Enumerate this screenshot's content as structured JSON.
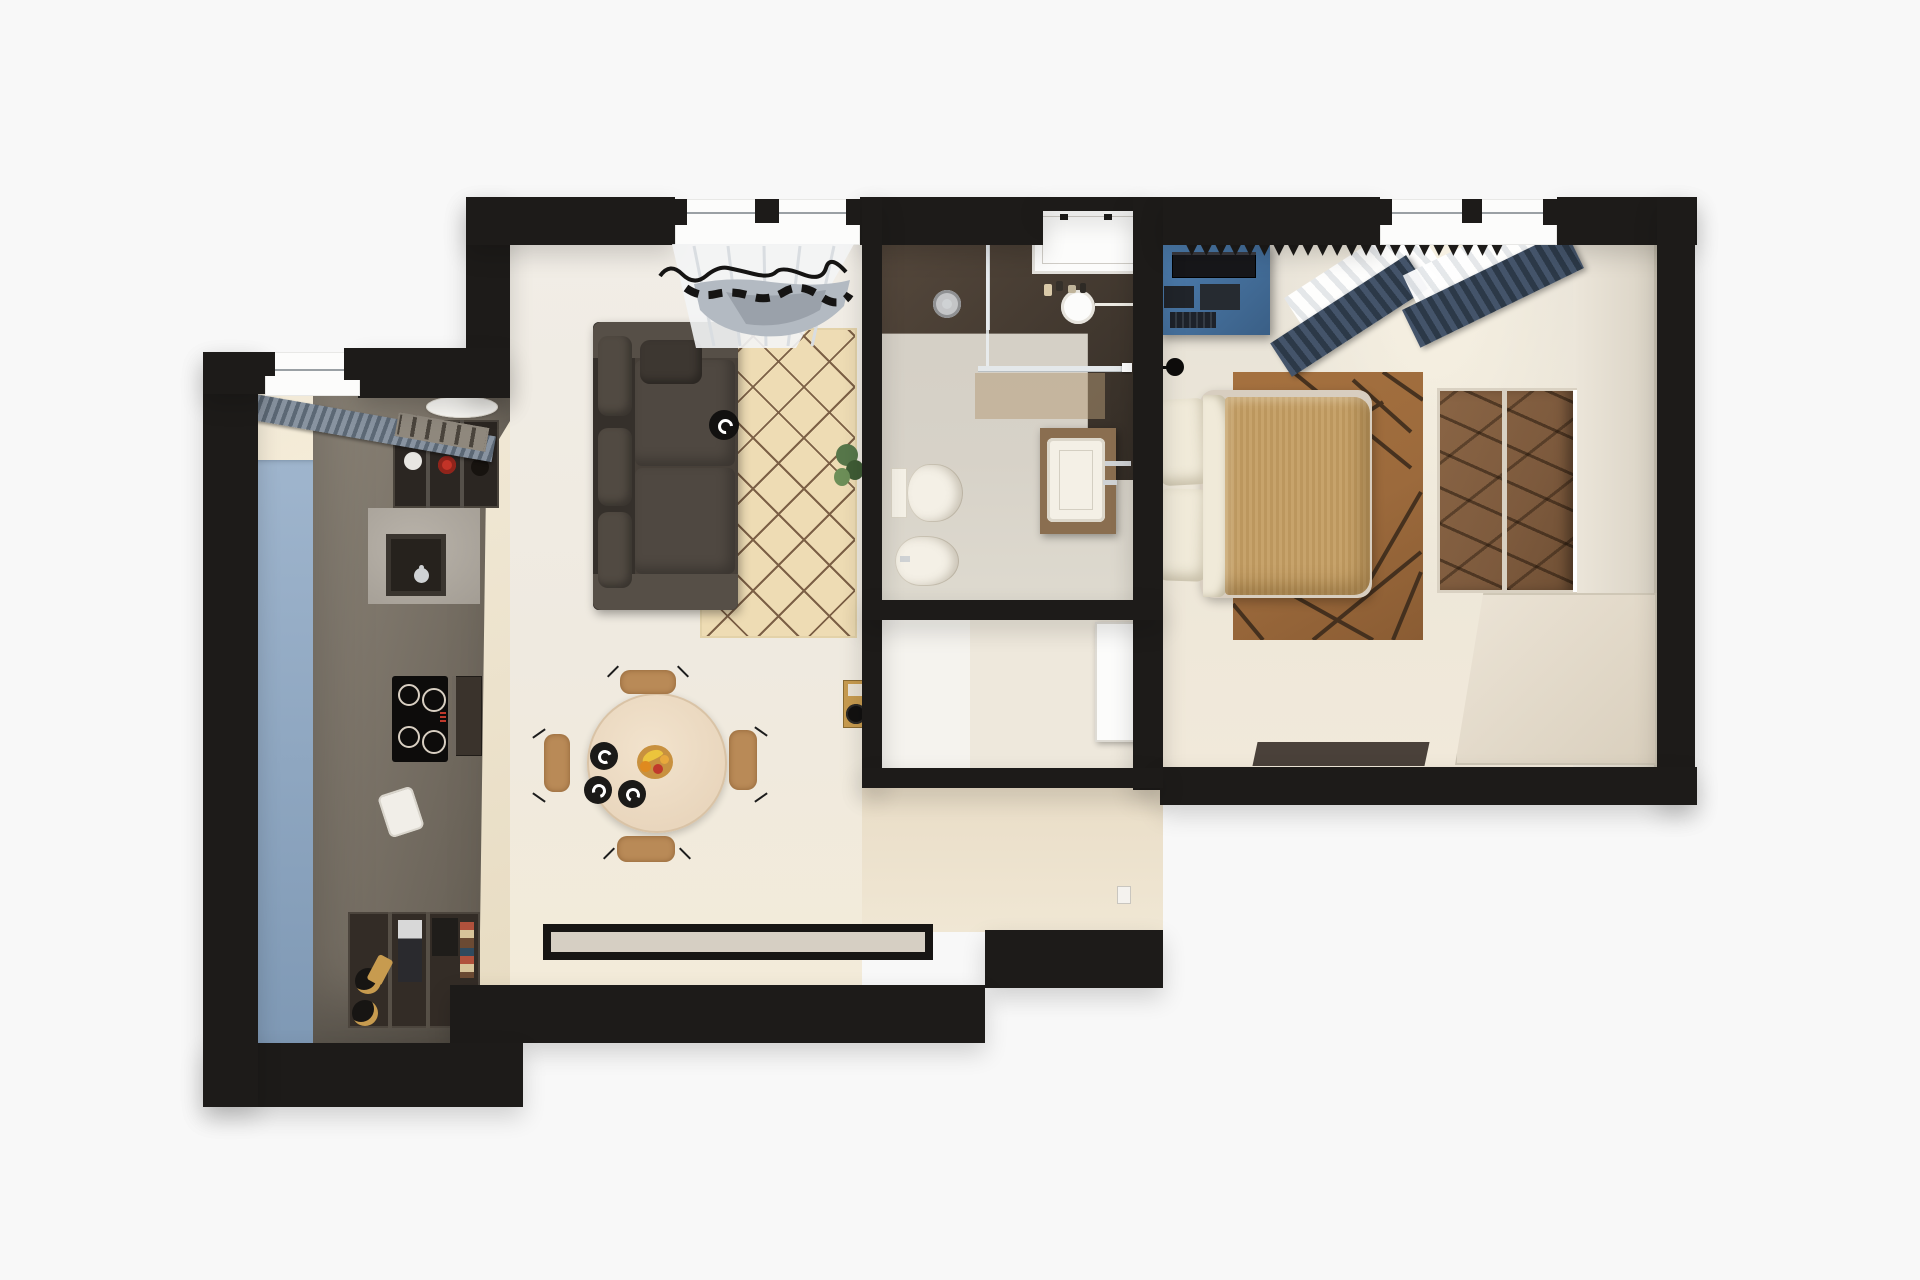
{
  "scene": {
    "type": "floor-plan-3d-top-view",
    "description": "Photorealistic top-down 3D render of a one-bedroom apartment floor plan on a white background, walls shown as black cut sections",
    "rooms": [
      {
        "id": "kitchen",
        "furniture": [
          "window-with-venetian-blind",
          "radiator-grille",
          "round-ceiling-plate",
          "tall-blue-cabinet-panel",
          "grey-cabinet-run",
          "bottle-cubby-shelf",
          "undermount-sink-with-faucet",
          "induction-cooktop",
          "built-in-oven",
          "toaster",
          "open-shelves-with-books",
          "coffee-machine",
          "wine-bottles"
        ],
        "cooktop_burners": 4
      },
      {
        "id": "living-dining-room",
        "furniture": [
          "window-with-sheer-and-grey-curtain",
          "dark-brown-sofa",
          "seat-cushions",
          "black-decor-plate",
          "diamond-pattern-tan-rug",
          "potted-plant",
          "wall-mounted-record-player",
          "round-wooden-dining-table",
          "black-plates",
          "fruit-bowl",
          "wooden-chairs",
          "black-bordered-runner-rug"
        ],
        "chairs": 4,
        "plates": 3,
        "fruit": [
          "bananas",
          "oranges",
          "red-apple"
        ]
      },
      {
        "id": "bathroom",
        "furniture": [
          "white-framed-window",
          "walk-in-shower",
          "shower-head",
          "glass-partition",
          "round-mirror",
          "cosmetic-bottles",
          "wood-vanity",
          "white-basin",
          "faucet",
          "wall-hung-toilet",
          "bidet"
        ]
      },
      {
        "id": "storage-nook",
        "furniture": [
          "white-door-ajar"
        ]
      },
      {
        "id": "hallway",
        "furniture": [
          "light-switch"
        ]
      },
      {
        "id": "bedroom",
        "furniture": [
          "window-with-sheer-curtain",
          "navy-pleated-curtains",
          "blue-desk",
          "tv-monitor",
          "black-wall-lamps",
          "double-bed",
          "white-pillows",
          "tan-duvet",
          "geometric-brown-rug",
          "mirrored-wardrobe",
          "dark-floor-mat"
        ],
        "wall_lamps": 2,
        "pillows": 2
      }
    ]
  },
  "glyphs": {
    "sawtooth_row_long": "▼▼▼▼▼▼▼▼▼▼▼▼▼▼▼▼▼▼▼▼▼▼",
    "sawtooth_row_small": "▼▼▼▼"
  },
  "colors": {
    "bg": "#f8f8f8",
    "wall": "#1d1b19",
    "window_white": "#fcfcfb",
    "glass": "#9aa0a4",
    "kitchen_floor_a": "#f2ead8",
    "kitchen_floor_b": "#e7dbc1",
    "living_floor_a": "#f1ede6",
    "living_floor_b": "#f3ebd9",
    "hall_floor_a": "#e9ddc7",
    "hall_floor_b": "#f0e7d4",
    "bath_floor": "#d7d2c8",
    "bath_dark_a": "#55483c",
    "bath_dark_b": "#342d26",
    "storage_floor": "#eee8dc",
    "door_swing": "#f5f3ee",
    "bedroom_floor_a": "#e6e1d7",
    "bedroom_floor_b": "#f1e9da",
    "wallface_a": "#ece6da",
    "wallface_b": "#d9d2c4",
    "blue_a": "#9fb5cd",
    "blue_b": "#7e98b4",
    "cab_a": "#8c8478",
    "cab_b": "#60594f",
    "cubby_dark": "#2b2622",
    "marble": "#a39d94",
    "sink_dark": "#26221d",
    "cooktop": "#0d0c0b",
    "burner_ring": "#d8cfc2",
    "oven": "#3a332c",
    "shelf_dark": "#332c26",
    "gold": "#c79b4f",
    "blind_a": "#8893a0",
    "blind_b": "#5c6875",
    "radiator": "#8f887d",
    "plate_white": "#fbfaf6",
    "sofa_base": "#474039",
    "sofa_dark": "#35302b",
    "sofa_cushion": "#4f4841",
    "sofa_arm": "#564f47",
    "rug_tan": "#eedcb4",
    "rug_line": "#7c6046",
    "runner_border": "#171513",
    "runner_inner": "#d6cfc3",
    "table_wood": "#e9d6bd",
    "chair_wood": "#b98a57",
    "plate_black": "#1b1a18",
    "bowl": "#c8913f",
    "banana": "#ecc43c",
    "orange_fruit": "#df8a1f",
    "apple_red": "#c0392b",
    "plant_a": "#57774a",
    "plant_b": "#3f5c35",
    "curtain_grey": "#b3bac2",
    "sheer_a": "#ffffff",
    "sheer_b": "#e4e7ea",
    "navy_a": "#44546a",
    "navy_b": "#2c3948",
    "fixture_white": "#f4f0e6",
    "chrome": "#cfd2d4",
    "vanity_wood": "#8a6e50",
    "rug_brown": "#9c6a3c",
    "rug_brown_line": "#38281a",
    "duvet": "#c49d62",
    "pillow_white": "#f0ead9",
    "bed_frame": "#d8cec0",
    "desk_a": "#4f80b2",
    "desk_b": "#3a5f86",
    "tv_dark": "#17171a",
    "mirror_refl": "#7d5a3d",
    "wardrobe_a": "#ece4d6",
    "wardrobe_b": "#d9cfbd",
    "mat_dark": "#4a413a"
  }
}
